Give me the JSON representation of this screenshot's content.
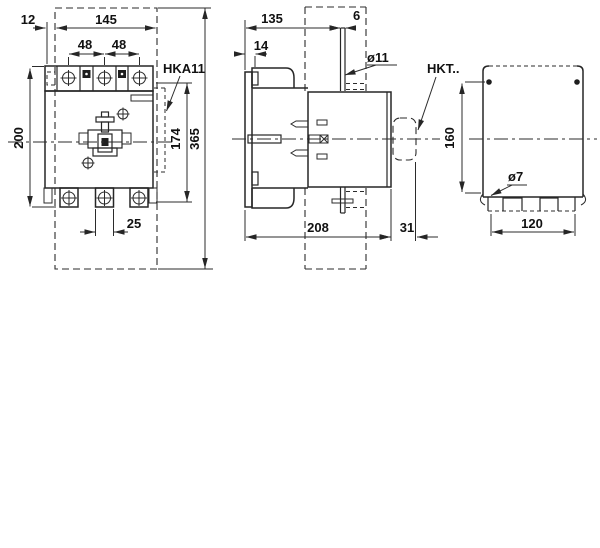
{
  "views": {
    "front": {
      "label": "HKA11",
      "dims": {
        "offset_left": "12",
        "width": "145",
        "pole_pitch_1": "48",
        "pole_pitch_2": "48",
        "body_height": "200",
        "aux_height": "174",
        "total_height": "365",
        "terminal_width": "25"
      }
    },
    "side": {
      "dims": {
        "depth_to_bracket": "135",
        "bracket_thickness": "6",
        "front_depth": "14",
        "bracket_hole": "ø11",
        "total_depth": "208",
        "interlock_depth": "31"
      }
    },
    "rear": {
      "label": "HKT..",
      "dims": {
        "hole_height": "160",
        "mounting_hole": "ø7",
        "hole_width": "120"
      }
    }
  }
}
